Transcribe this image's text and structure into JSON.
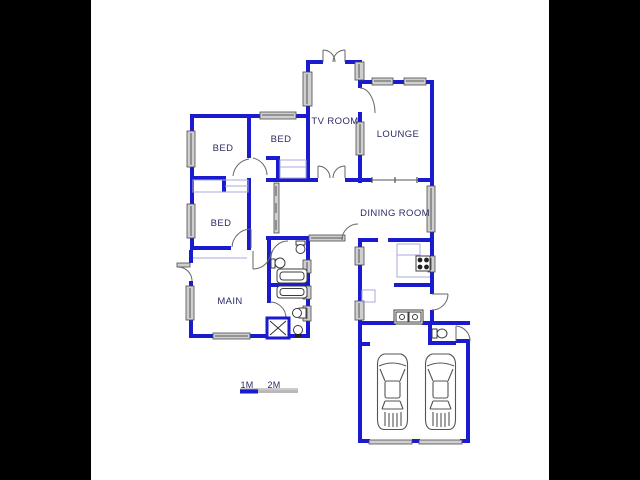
{
  "image": {
    "kind": "scanned floor plan drawing",
    "matte_color": "#000000",
    "paper_color": "#ffffff",
    "wall_color": "#1a1ace",
    "label_color": "#2b2b66"
  },
  "plan": {
    "rooms": [
      {
        "id": "tv-room",
        "label": "TV ROOM"
      },
      {
        "id": "lounge",
        "label": "LOUNGE"
      },
      {
        "id": "bed-1",
        "label": "BED"
      },
      {
        "id": "bed-2",
        "label": "BED"
      },
      {
        "id": "bed-3",
        "label": "BED"
      },
      {
        "id": "dining-room",
        "label": "DINING ROOM"
      },
      {
        "id": "main-bedroom",
        "label": "MAIN"
      }
    ],
    "fixtures": [
      "toilet",
      "bathtub",
      "shower",
      "wash-basin",
      "double-sink",
      "stove",
      "kitchen-counter",
      "built-in-cupboard",
      "car",
      "garage-door",
      "window",
      "door-swing"
    ],
    "scale_bar": {
      "labels": [
        "1M",
        "2M"
      ],
      "bar_blue": "#1a1ace",
      "bar_gray": "#b9b9b9"
    }
  }
}
